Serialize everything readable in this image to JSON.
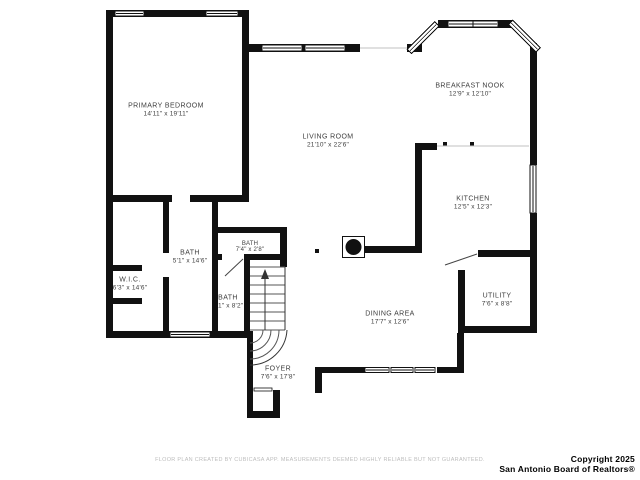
{
  "rooms": [
    {
      "name": "PRIMARY BEDROOM",
      "dims": "14'11\" x 19'11\""
    },
    {
      "name": "BREAKFAST NOOK",
      "dims": "12'9\" x 12'10\""
    },
    {
      "name": "LIVING ROOM",
      "dims": "21'10\" x 22'6\""
    },
    {
      "name": "KITCHEN",
      "dims": "12'5\" x 12'3\""
    },
    {
      "name": "BATH",
      "dims": "5'1\" x 14'6\""
    },
    {
      "name": "BATH",
      "dims": "7'4\" x 2'8\""
    },
    {
      "name": "W.I.C.",
      "dims": "6'3\" x 14'6\""
    },
    {
      "name": "BATH",
      "dims": "3'1\" x 8'2\""
    },
    {
      "name": "DINING AREA",
      "dims": "17'7\" x 12'6\""
    },
    {
      "name": "UTILITY",
      "dims": "7'6\" x 8'8\""
    },
    {
      "name": "FOYER",
      "dims": "7'6\" x 17'8\""
    }
  ],
  "footer": {
    "disclaimer": "FLOOR PLAN CREATED BY CUBICASA APP. MEASUREMENTS DEEMED HIGHLY RELIABLE BUT NOT GUARANTEED.",
    "copyright_line1": "Copyright 2025",
    "copyright_line2": "San Antonio Board of Realtors®"
  },
  "colors": {
    "wall": "#111111",
    "label_text": "#3e3e3e",
    "disclaimer_text": "#bdbdbd",
    "copyright_text": "#000000"
  }
}
